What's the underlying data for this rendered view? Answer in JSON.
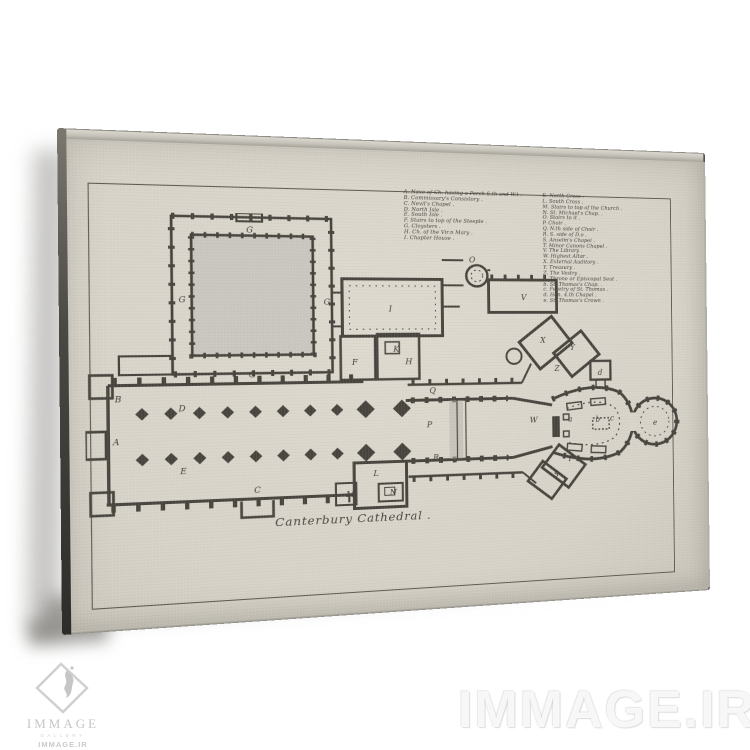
{
  "artwork": {
    "title": "Canterbury Cathedral .",
    "legend_left": [
      "A. Nave of Ch. having a Porch S.th and W.t .",
      "B. Commissary's Consistory .",
      "C. Nevil's Chapel .",
      "D. North Isle .",
      "E. South Isle .",
      "F. Stairs to top of the Steeple .",
      "G. Cloysters .",
      "H. Ch. of the Vir.n Mary .",
      "I. Chapter House ."
    ],
    "legend_right": [
      "K. North Cross .",
      "L. South Cross .",
      "M. Stairs to top of the Church .",
      "N. St. Michael's Chap. .",
      "O. Stairs to it .",
      "P. Choir .",
      "Q. N.th side of Choir .",
      "R. S. side of D.o .",
      "S. Anselm's Chapel .",
      "T. Minor Canons Chapel .",
      "V. The Library .",
      "W. Highest Altar .",
      "X. External Auditory .",
      "Y. Treasury .",
      "Z. The Vestry .",
      "a. Throne or Episcopal Seat .",
      "b. St. Thomas's Chap. .",
      "c. Feretry of St. Thomas .",
      "d. Hen. 4.th Chapel .",
      "e. St. Thomas's Crown ."
    ],
    "plan_labels": [
      {
        "t": "G",
        "x": 147,
        "y": 19
      },
      {
        "t": "G",
        "x": 84,
        "y": 88
      },
      {
        "t": "G",
        "x": 220,
        "y": 90
      },
      {
        "t": "G",
        "x": 148,
        "y": 162
      },
      {
        "t": "I",
        "x": 284,
        "y": 97
      },
      {
        "t": "O",
        "x": 366,
        "y": 46
      },
      {
        "t": "V",
        "x": 420,
        "y": 85
      },
      {
        "t": "B",
        "x": 26,
        "y": 184
      },
      {
        "t": "A",
        "x": 24,
        "y": 225
      },
      {
        "t": "D",
        "x": 83,
        "y": 194
      },
      {
        "t": "E",
        "x": 84,
        "y": 255
      },
      {
        "t": "C",
        "x": 152,
        "y": 276
      },
      {
        "t": "F",
        "x": 247,
        "y": 151
      },
      {
        "t": "H",
        "x": 300,
        "y": 151
      },
      {
        "t": "K",
        "x": 288,
        "y": 138
      },
      {
        "t": "L",
        "x": 267,
        "y": 264
      },
      {
        "t": "M",
        "x": 240,
        "y": 284
      },
      {
        "t": "N",
        "x": 283,
        "y": 284
      },
      {
        "t": "P",
        "x": 321,
        "y": 216
      },
      {
        "t": "Q",
        "x": 324,
        "y": 181
      },
      {
        "t": "R",
        "x": 327,
        "y": 250
      },
      {
        "t": "W",
        "x": 428,
        "y": 214
      },
      {
        "t": "X",
        "x": 440,
        "y": 130
      },
      {
        "t": "Y",
        "x": 472,
        "y": 138
      },
      {
        "t": "Z",
        "x": 455,
        "y": 160
      },
      {
        "t": "T",
        "x": 468,
        "y": 256
      },
      {
        "t": "S",
        "x": 453,
        "y": 272
      },
      {
        "t": "a",
        "x": 469,
        "y": 214
      },
      {
        "t": "b",
        "x": 499,
        "y": 215
      },
      {
        "t": "c",
        "x": 515,
        "y": 214
      },
      {
        "t": "d",
        "x": 502,
        "y": 165
      },
      {
        "t": "e",
        "x": 563,
        "y": 220
      }
    ]
  },
  "watermark": {
    "text": "IMMAGE.IR",
    "logo_brand": "IMMAGE",
    "logo_subtitle": "GALLERY",
    "logo_domain": "IMMAGE.IR"
  },
  "colors": {
    "paper": "#d9d5cb",
    "ink": "#45433c",
    "canvas_side_dark": "#3a3834",
    "canvas_top_edge": "#c6c3bb",
    "garth_fill": "#c9c7bf",
    "watermark_gray": "#cbcbcb"
  }
}
